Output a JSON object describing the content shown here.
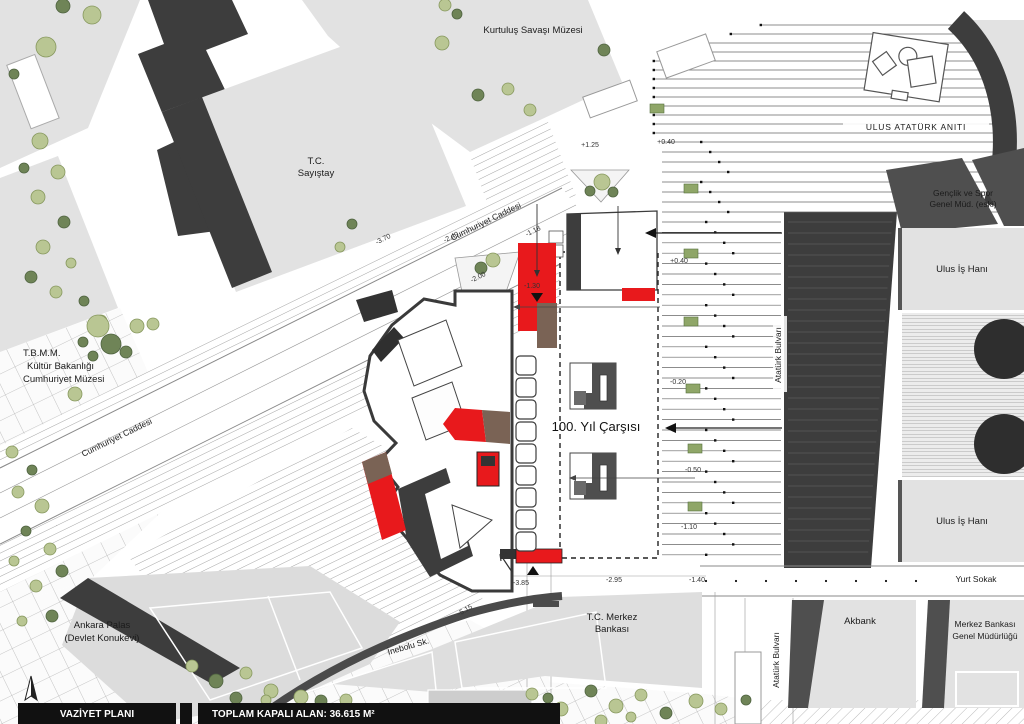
{
  "footer": {
    "left": "VAZİYET PLANI",
    "right": "TOPLAM KAPALI ALAN: 36.615 M²"
  },
  "north": {
    "letter": "K"
  },
  "places": {
    "kurtulus_muzesi": "Kurtuluş Savaşı Müzesi",
    "sayistay_l1": "T.C.",
    "sayistay_l2": "Sayıştay",
    "ulus_ataturk_aniti": "ULUS ATATÜRK ANITI",
    "genclik_l1": "Gençlik ve Spor",
    "genclik_l2": "Genel Müd. (eski)",
    "ulus_is_hani_north": "Ulus İş Hanı",
    "ulus_is_hani_south": "Ulus İş Hanı",
    "tbmm_l1": "T.B.M.M.",
    "tbmm_l2": "Kültür Bakanlığı",
    "tbmm_l3": "Cumhuriyet Müzesi",
    "cumhuriyet_caddesi_upper": "Cumhuriyet Caddesi",
    "cumhuriyet_caddesi_lower": "Cumhuriyet Caddesi",
    "yuzuncu_yil_carsisi": "100. Yıl Çarşısı",
    "ataturk_bulvari_north": "Atatürk Bulvarı",
    "ataturk_bulvari_south": "Atatürk Bulvarı",
    "yurt_sokak": "Yurt Sokak",
    "merkez_bankasi_l1": "T.C. Merkez",
    "merkez_bankasi_l2": "Bankası",
    "akbank": "Akbank",
    "mb_genel_l1": "Merkez Bankası",
    "mb_genel_l2": "Genel Müdürlüğü",
    "ankara_palas_l1": "Ankara Palas",
    "ankara_palas_l2": "(Devlet Konukevi)",
    "inebolu_sk": "İnebolu Sk."
  },
  "elevations": {
    "road_1": "-3.70",
    "road_2": "-2.40",
    "road_3": "-2.00",
    "road_4": "-1.18",
    "entrance": "-1.30",
    "blvd_1": "+1.25",
    "blvd_2": "+0.40",
    "blvd_3": "+0.40",
    "blvd_4": "-0.20",
    "blvd_5": "-0.50",
    "blvd_6": "-1.10",
    "south_1": "-3.85",
    "south_2": "-2.95",
    "south_3": "-1.40",
    "south_4": "-5.15"
  },
  "icons": {
    "north_arrow": "north-arrow",
    "monument": "ulus-monument-plan",
    "tree": "tree-canopy",
    "entrance_arrow": "entrance-direction-arrow"
  },
  "colors": {
    "highlight_red": "#e8191c",
    "ramp_brown": "#7a6355",
    "building_dark": "#3d3d3d",
    "block_gray": "#e2e2e2",
    "tree_light": "#b9c693",
    "tree_dark": "#6f8457",
    "median_green": "#8fa668"
  }
}
